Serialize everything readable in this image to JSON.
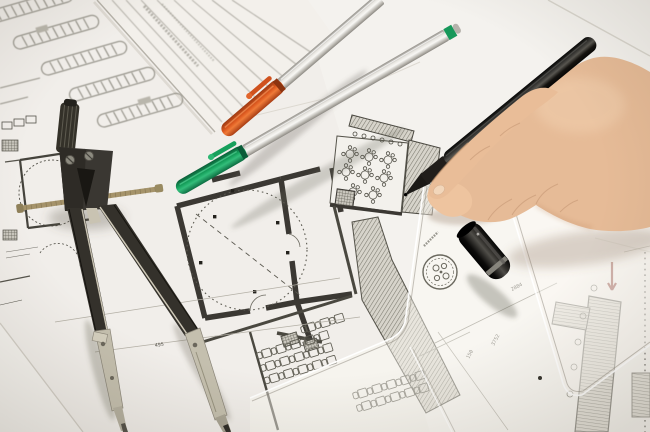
{
  "scene": {
    "description": "Photograph of an architect's desk: overlapping floor-plan and site-plan drawings, a black drafting compass, two silver marker pens with orange and green caps, transparent set-square templates, a black pen cap, and a right hand drawing on the plans with a black pen."
  },
  "objects": {
    "compass": {
      "label": "drafting compass",
      "body_color": "#34312b",
      "metal_color": "#c4bfae",
      "brass_color": "#a5936a"
    },
    "pen_orange": {
      "label": "marker pen with orange cap",
      "cap_color": "#d8551f",
      "body_color": "#d9d7d2"
    },
    "pen_green": {
      "label": "marker pen with green cap",
      "cap_color": "#17985a",
      "body_color": "#d9d7d2"
    },
    "pen_black": {
      "label": "black drawing pen held in hand",
      "color": "#17140f"
    },
    "pen_cap_black": {
      "label": "black pen cap",
      "color": "#17140f",
      "ring_color": "#8f8d84"
    },
    "hand": {
      "label": "right hand drawing",
      "skin_color": "#e6bb97"
    },
    "clear_template": {
      "label": "transparent drafting template with round logo stamp"
    },
    "clear_set_square": {
      "label": "transparent set square"
    },
    "drawings": {
      "label": "architectural floor plans and site plan",
      "line_color": "#55534b",
      "wall_color": "#3b3833"
    }
  },
  "drawing": {
    "dimensions": [
      {
        "text": "495"
      },
      {
        "text": "150"
      },
      {
        "text": "3752"
      },
      {
        "text": "2084"
      }
    ],
    "red_mark_color": "#7a2018"
  },
  "palette": {
    "paper": "#f1eeea",
    "paper_shadow": "#ddd9d1",
    "hatch_fill": "#d7d4cb",
    "hatch_line": "#7b796e"
  }
}
